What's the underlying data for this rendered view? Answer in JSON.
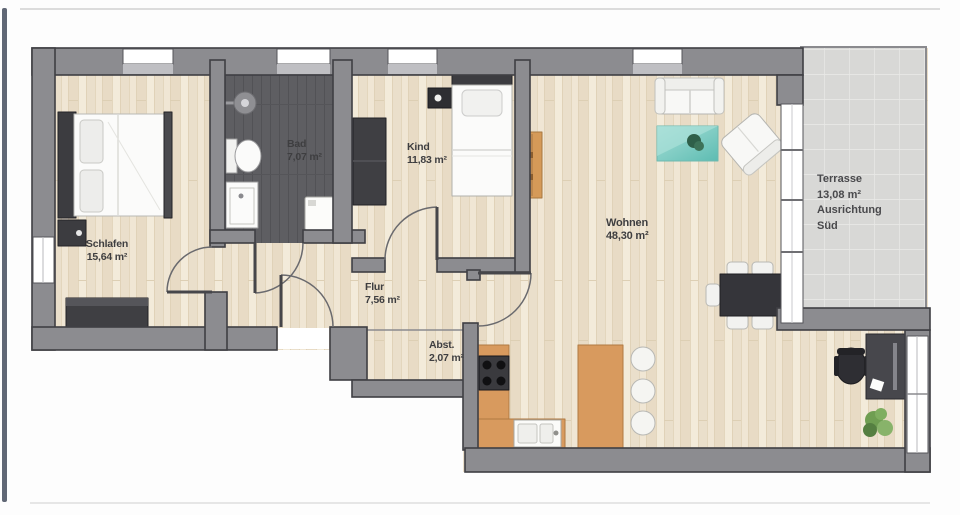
{
  "plan": {
    "type": "apartment-floor-plan",
    "language": "de"
  },
  "rooms": {
    "schlafen": {
      "name": "Schlafen",
      "area": "15,64 m²"
    },
    "bad": {
      "name": "Bad",
      "area": "7,07 m²"
    },
    "kind": {
      "name": "Kind",
      "area": "11,83 m²"
    },
    "flur": {
      "name": "Flur",
      "area": "7,56 m²"
    },
    "abstellraum": {
      "name": "Abst.",
      "area": "2,07 m²"
    },
    "wohnen": {
      "name": "Wohnen",
      "area": "48,30 m²"
    },
    "terrasse": {
      "name": "Terrasse",
      "area": "13,08 m²",
      "orientation_label": "Ausrichtung",
      "orientation_value": "Süd"
    }
  },
  "colors": {
    "wall": "#8c8c90",
    "wall_outline": "#3f3f44",
    "wood_floor": "#ede3d1",
    "bathroom_floor": "#5e5e62",
    "kitchen_counter": "#d89a5e",
    "coffee_table": "#7fccc3",
    "terrace_tile": "#d8d8d6",
    "dark_furniture": "#3a3a3e",
    "label_text": "#3e3e40"
  }
}
